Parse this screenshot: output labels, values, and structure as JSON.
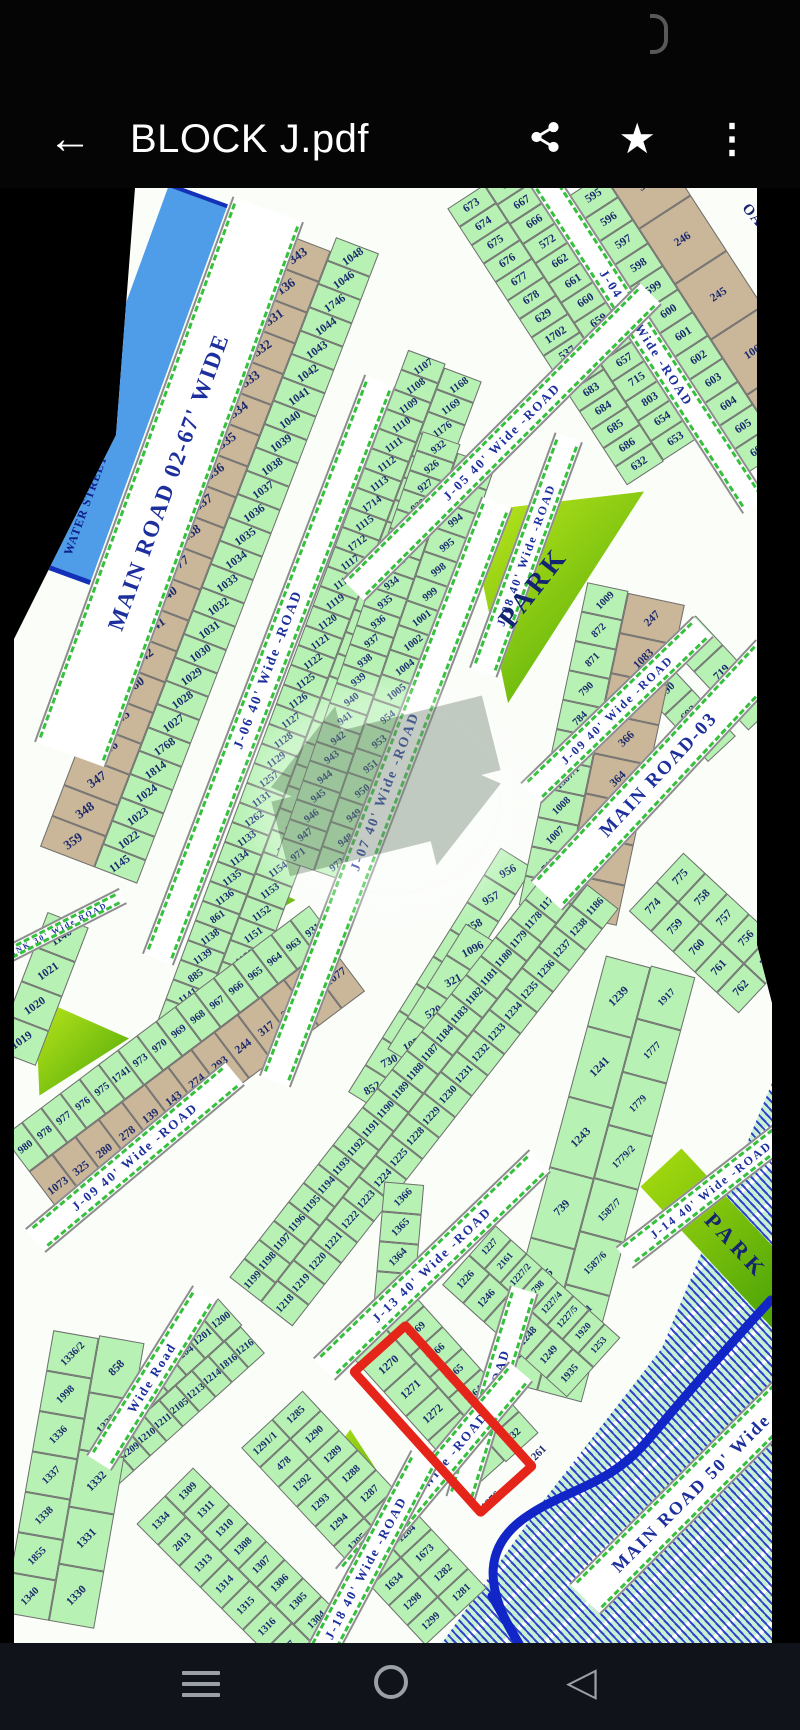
{
  "app_bar": {
    "title": "BLOCK J.pdf"
  },
  "colors": {
    "plot_green": "#b7f2b4",
    "plot_tan": "#cab699",
    "road_text": "#1d2f9c",
    "park_green_1": "#c8ee1c",
    "park_green_2": "#45a309",
    "highlight_red": "#e5241a",
    "water_blue": "#4f9ce8",
    "hatch_blue": "#1228c8"
  },
  "map": {
    "labels": {
      "water": "WATER STREET",
      "park": "PARK",
      "oad_partial": "OAD"
    },
    "roads": {
      "main02": "MAIN ROAD 02-67' WIDE",
      "j04": "J-04 40' Wide -ROAD",
      "j05": "J-05 40' Wide -ROAD",
      "j06": "J-06 40' Wide -ROAD",
      "j07": "J-07 40' Wide -ROAD",
      "j08": "J-08 40' Wide -ROAD",
      "j09": "J-09 40' Wide -ROAD",
      "j09b": "J-09 40' Wide -ROAD",
      "main03": "MAIN ROAD-03",
      "j13": "J-13 40' Wide -ROAD",
      "j14": "J-14 40' Wide -ROAD",
      "j17": "J-17 40' Wide -ROAD",
      "j18": "J-18 40' Wide -ROAD",
      "wide_road": "Wide Road",
      "wide_road2": "Wide -ROAD",
      "link": "LINK 30' Wide ROAD",
      "main50": "MAIN ROAD 50' Wide"
    },
    "blocks": {
      "t1_left": [
        "673",
        "674",
        "675",
        "676",
        "677",
        "678",
        "629",
        "1702",
        "537",
        "682",
        "683",
        "684",
        "685",
        "686",
        "632"
      ],
      "t1_right": [
        "668",
        "667",
        "666",
        "572",
        "662",
        "661",
        "660",
        "659",
        "658",
        "657",
        "715",
        "803",
        "654",
        "653"
      ],
      "t2_tan": [
        "365",
        "246",
        "245",
        "1062",
        "243"
      ],
      "t2_green": [
        "595",
        "596",
        "597",
        "598",
        "599",
        "600",
        "601",
        "602",
        "603",
        "604",
        "605",
        "606"
      ],
      "t3": [
        "689",
        "690",
        "692",
        "694"
      ],
      "t4": [
        "550",
        "719",
        "649"
      ],
      "c1": [
        "1146",
        "1021",
        "1020",
        "1019"
      ],
      "c2_tan": [
        "343",
        "136",
        "331",
        "332",
        "333",
        "334",
        "335",
        "336",
        "337",
        "338",
        "377",
        "340",
        "341",
        "342",
        "1080",
        "345",
        "346",
        "347",
        "348",
        "359"
      ],
      "c3_green": [
        "1048",
        "1046",
        "1746",
        "1044",
        "1043",
        "1042",
        "1041",
        "1040",
        "1039",
        "1038",
        "1037",
        "1036",
        "1035",
        "1034",
        "1033",
        "1032",
        "1031",
        "1030",
        "1029",
        "1028",
        "1027",
        "1768",
        "1814",
        "1024",
        "1023",
        "1022",
        "1145"
      ],
      "c4": [
        "1107",
        "1108",
        "1109",
        "1110",
        "1111",
        "1112",
        "1113",
        "1714",
        "1115",
        "1712",
        "1117",
        "1118",
        "1119",
        "1120",
        "1121",
        "1122",
        "1125",
        "1126",
        "1127",
        "1128",
        "1129",
        "1257",
        "1131",
        "1262",
        "1133",
        "1134",
        "1135",
        "1136",
        "861",
        "1138",
        "1139",
        "885",
        "1141",
        "1142",
        "1143",
        "1123"
      ],
      "c5": [
        "1168",
        "1169",
        "1176",
        "1175",
        "1174",
        "1173",
        "1172",
        "1171",
        "1170",
        "1167",
        "1166",
        "1165",
        "1164",
        "1163",
        "1162",
        "1161",
        "1160",
        "1159",
        "1158",
        "1157",
        "1156",
        "1155",
        "1154",
        "1153",
        "1152",
        "1151",
        "1150",
        "1149",
        "1148",
        "1147",
        "1828",
        "1124"
      ],
      "c6": [
        "932",
        "926",
        "927",
        "928",
        "929",
        "930",
        "933",
        "934",
        "935",
        "936",
        "937",
        "938",
        "939",
        "940",
        "941",
        "942",
        "943",
        "944",
        "945",
        "946",
        "947",
        "971"
      ],
      "c7": [
        "994/2",
        "994/1",
        "994",
        "995",
        "998",
        "999",
        "1001",
        "1002",
        "1004",
        "1005",
        "954",
        "953",
        "951",
        "950",
        "949",
        "948",
        "972"
      ],
      "c8": [
        "956",
        "957",
        "958",
        "959",
        "960",
        "961",
        "962",
        "730",
        "852"
      ],
      "c9": [
        "1096",
        "321",
        "520",
        "1078"
      ],
      "pk_green": [
        "1009",
        "872",
        "871",
        "790",
        "784",
        "952",
        "1587/1",
        "1008",
        "1007",
        "711",
        "955"
      ],
      "pk_tan": [
        "247",
        "1083",
        "374",
        "366",
        "364",
        "362",
        "330",
        "327"
      ],
      "m1_right": [
        "775",
        "758",
        "757",
        "756",
        "763"
      ],
      "m1_left": [
        "774",
        "759",
        "760",
        "761",
        "762"
      ],
      "b1_left": [
        "1185",
        "1177",
        "1178",
        "1179",
        "1180",
        "1181",
        "1182",
        "1183",
        "1184",
        "1187",
        "1188",
        "1189",
        "1190",
        "1191",
        "1192",
        "1193",
        "1194",
        "1195",
        "1196",
        "1197",
        "1198",
        "1199"
      ],
      "b1_right": [
        "1186",
        "1238",
        "1237",
        "1236",
        "1235",
        "1234",
        "1233",
        "1232",
        "1231",
        "1230",
        "1229",
        "1228",
        "1225",
        "1224",
        "1223",
        "1222",
        "1221",
        "1220",
        "1219",
        "1218"
      ],
      "b2_left": [
        "1239",
        "1241",
        "1243",
        "739",
        "1245",
        "1251"
      ],
      "b2_right": [
        "1917",
        "1777",
        "1779",
        "1779/2",
        "1587/7",
        "1587/6",
        "1251/1",
        "776/1"
      ],
      "b3_left": [
        "1200",
        "1201",
        "1204",
        "1205",
        "1206",
        "1207",
        "1208",
        "1202"
      ],
      "b3_right": [
        "1216",
        "1816",
        "1214",
        "1213",
        "2105",
        "1211",
        "1210",
        "1209",
        "1203"
      ],
      "b4_outer": [
        "1267",
        "1269",
        "1266",
        "1265",
        "1264",
        "1263",
        "1132"
      ],
      "b4_red": [
        "1268",
        "1270",
        "1271",
        "1272",
        "1273",
        "1274"
      ],
      "b4_far": [
        "1366",
        "1365",
        "1364",
        "1363"
      ],
      "b5_left": [
        "1226",
        "1246",
        "1247",
        "1248",
        "1249",
        "1935"
      ],
      "b5_right": [
        "1227",
        "2161",
        "1227/2",
        "1798",
        "1227/4",
        "1227/5",
        "1920",
        "1253"
      ],
      "b6_green": [
        "931",
        "963",
        "964",
        "965",
        "966",
        "967",
        "968",
        "969",
        "970",
        "973",
        "1741",
        "975",
        "976",
        "977",
        "978",
        "980"
      ],
      "b6_tan": [
        "1077",
        "1105",
        "319",
        "317",
        "244",
        "293",
        "274",
        "143",
        "139",
        "278",
        "280",
        "325",
        "1073"
      ],
      "b7_left": [
        "1336/2",
        "1998",
        "1336",
        "1337",
        "1338",
        "1855",
        "1340"
      ],
      "b7_right": [
        "858",
        "1333",
        "1332",
        "1331",
        "1330"
      ],
      "b8_left": [
        "1334",
        "2013",
        "1313",
        "1314",
        "1315",
        "1316",
        "317"
      ],
      "b8_right": [
        "1309",
        "1311",
        "1310",
        "1308",
        "1307",
        "1306",
        "1305",
        "1304"
      ],
      "b9_left": [
        "1291/1",
        "478",
        "1292",
        "1293",
        "1294",
        "1295",
        "1296",
        "1634",
        "1298",
        "1299"
      ],
      "b9_right": [
        "1285",
        "1290",
        "1289",
        "1288",
        "1287",
        "1286",
        "1284",
        "1673",
        "1282",
        "1281"
      ],
      "hatch": [
        "1276",
        "1261"
      ]
    }
  }
}
